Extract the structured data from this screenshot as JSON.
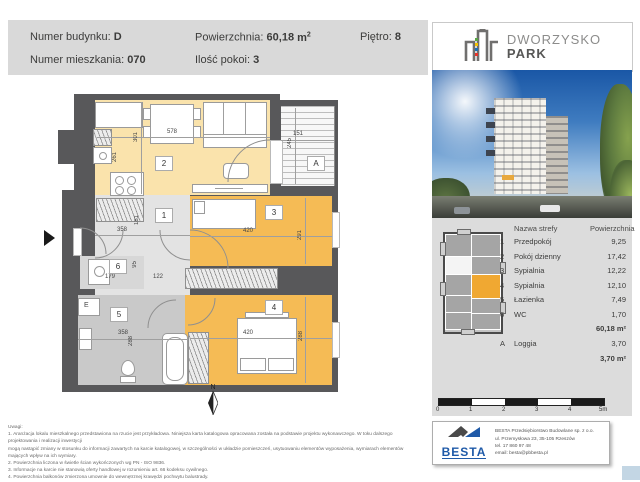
{
  "header": {
    "building_label": "Numer budynku:",
    "building_value": "D",
    "apartment_label": "Numer mieszkania:",
    "apartment_value": "070",
    "area_label": "Powierzchnia:",
    "area_value": "60,18",
    "area_unit": "m²",
    "rooms_label": "Ilość pokoi:",
    "rooms_value": "3",
    "floor_label": "Piętro:",
    "floor_value": "8"
  },
  "brand": {
    "line1": "DWORZYSKO",
    "line2": "PARK"
  },
  "plan": {
    "compass": "N",
    "closet_label": "E",
    "room_labels": {
      "hall": "1",
      "living": "2",
      "bed3": "3",
      "bed4": "4",
      "bath": "5",
      "wc": "6",
      "loggia": "A"
    },
    "dims": [
      "578",
      "301",
      "261",
      "151",
      "245",
      "420",
      "291",
      "358",
      "181",
      "179",
      "95",
      "122",
      "358",
      "288",
      "420",
      "288"
    ]
  },
  "legend": {
    "col_name": "Nazwa strefy",
    "col_area": "Powierzchnia",
    "rows": [
      {
        "no": "1",
        "name": "Przedpokój",
        "area": "9,25"
      },
      {
        "no": "2",
        "name": "Pokój dzienny",
        "area": "17,42"
      },
      {
        "no": "3",
        "name": "Sypialnia",
        "area": "12,22"
      },
      {
        "no": "4",
        "name": "Sypialnia",
        "area": "12,10"
      },
      {
        "no": "5",
        "name": "Łazienka",
        "area": "7,49"
      },
      {
        "no": "6",
        "name": "WC",
        "area": "1,70"
      }
    ],
    "total": "60,18 m²",
    "loggia": {
      "no": "A",
      "name": "Loggia",
      "area": "3,70"
    },
    "loggia_total": "3,70 m²"
  },
  "scale": {
    "labels": [
      "0",
      "1",
      "2",
      "3",
      "4",
      "5m"
    ]
  },
  "notes": {
    "title": "Uwagi:",
    "lines": [
      "1. Aranżacja lokalu mieszkalnego przedstawiona na rzucie jest przykładowa. Niniejsza karta katalogowa opracowana została na podstawie projektu wykonawczego. W toku dalszego projektowania i realizacji inwestycji",
      "mogą nastąpić zmiany w stosunku do informacji zawartych na karcie katalogowej, w szczególności w układzie pomieszczeń, usytuowaniu elementów wyposażenia, wymiarach elementów mających wpływ na ich wymiary.",
      "2. Powierzchnia liczona w świetle ścian wykończonych wg PN - ISO 9836.",
      "3. Informacje na karcie nie stanowią oferty handlowej w rozumieniu art. 66 kodeksu cywilnego.",
      "4. Powierzchnia balkonów zmierzona umownie do wewnętrznej krawędzi pochwytu balustrady."
    ]
  },
  "besta": {
    "name": "BESTA",
    "address": [
      "BESTA Przedsiębiorstwo Budowlane sp. z o.o.",
      "ul. Przemysłowa 23, 35-105 Rzeszów",
      "tel. 17 860 97 48",
      "email: besta@pbbesta.pl"
    ]
  },
  "colors": {
    "wall": "#58585a",
    "living": "#fae3ac",
    "bedroom": "#f5bb55",
    "highlight": "#f0a832",
    "besta_blue": "#1f5aa8"
  }
}
